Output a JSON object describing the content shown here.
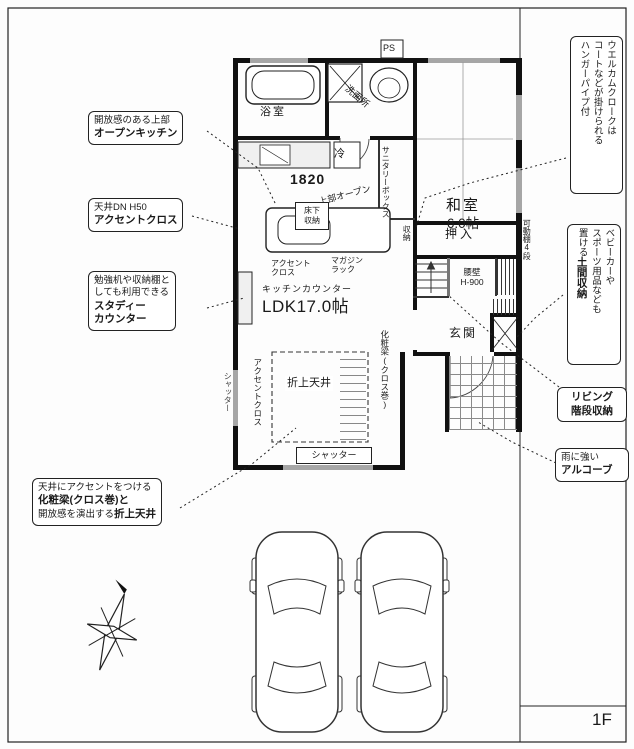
{
  "page": {
    "floor_label": "1F"
  },
  "colors": {
    "line": "#1a1a1a",
    "wall": "#111111",
    "window_gray": "#a6a6a6"
  },
  "callouts": {
    "open_kitchen": {
      "line1": "開放感のある上部",
      "line2": "オープンキッチン"
    },
    "accent_dn": {
      "line1": "天井DN H50",
      "line2": "アクセントクロス"
    },
    "study_counter": {
      "line1": "勉強机や収納棚と",
      "line2": "しても利用できる",
      "line3": "スタディー",
      "line4": "カウンター"
    },
    "ceiling_beam": {
      "line1": "天井にアクセントをつける",
      "line2": "化粧梁(クロス巻)と",
      "line3a": "開放感を演出する",
      "line3b": "折上天井"
    },
    "welcome_cloak": {
      "line1": "ウエルカムクロークは",
      "line2": "コートなどが掛けられる",
      "line3": "ハンガーパイプ付"
    },
    "doma_storage": {
      "line1": "ベビーカーや",
      "line2": "スポーツ用品なども",
      "line3a": "置ける",
      "line3b": "土間収納"
    },
    "living_stairs": {
      "line1": "リビング",
      "line2": "階段収納"
    },
    "alcove": {
      "line1": "雨に強い",
      "line2": "アルコーブ"
    }
  },
  "plan": {
    "ps": "PS",
    "bath": "浴室",
    "washroom": "洗面所",
    "fridge": "冷",
    "dim_1820": "1820",
    "sanitary_box": "サニタリーボックス",
    "upper_open": "上部オープン",
    "floor_storage_l1": "床下",
    "floor_storage_l2": "収納",
    "accent_cross_l1": "アクセント",
    "accent_cross_l2": "クロス",
    "magazine_l1": "マガジン",
    "magazine_l2": "ラック",
    "kitchen_counter": "キッチンカウンター",
    "ldk": "LDK17.0帖",
    "beam_wrap": "化粧梁(クロス巻)",
    "coved_ceiling": "折上天井",
    "accent_cross_v": "アクセントクロス",
    "shutter_left": "シャッター",
    "shutter_bottom": "シャッター",
    "washitsu_l1": "和室",
    "washitsu_l2": "6.0帖",
    "oshiire": "押入",
    "shuno": "収納",
    "koshikabe_l1": "腰壁",
    "koshikabe_l2": "H-900",
    "genkan": "玄関",
    "movable_shelf": "可動棚4段"
  }
}
